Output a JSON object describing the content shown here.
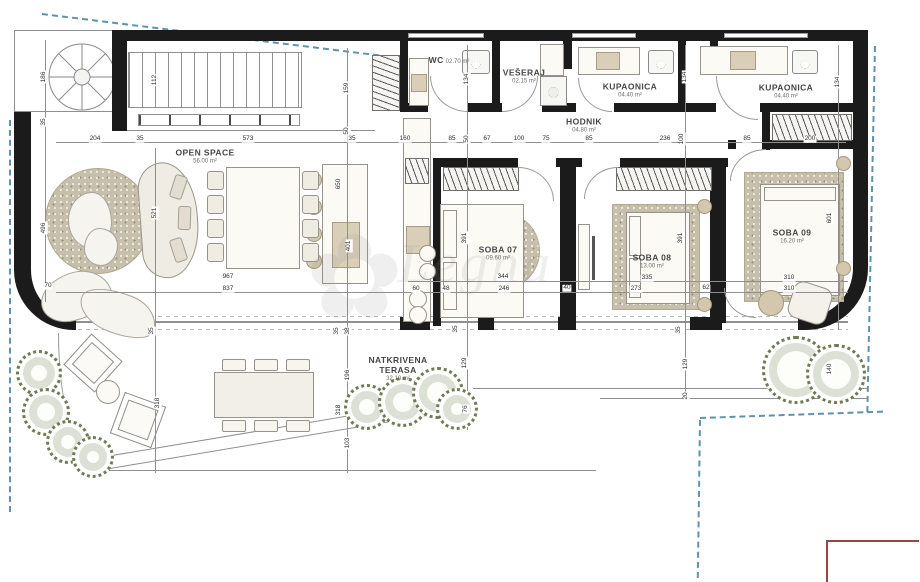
{
  "watermark": {
    "text": "Legna",
    "flower": "✿"
  },
  "colors": {
    "wall": "#1b1b1b",
    "thin_line": "#8f8f8f",
    "boundary": "#5d93ad",
    "red_outline": "#9a4543",
    "carpet": "#c6bfab",
    "fixture_beige": "#d9cfb8",
    "bush_green": "#6f7a57"
  },
  "rooms": [
    {
      "id": "open-space",
      "name": "OPEN SPACE",
      "area": "56.00 m²",
      "x": 205,
      "y": 157
    },
    {
      "id": "wc",
      "name": "WC",
      "area": "02.70 m²",
      "x": 449,
      "y": 61,
      "inline": true
    },
    {
      "id": "veseraj",
      "name": "VEŠERAJ",
      "area": "02.15 m²",
      "x": 524,
      "y": 77
    },
    {
      "id": "kupaonica-1",
      "name": "KUPAONICA",
      "area": "04.40 m²",
      "x": 630,
      "y": 91
    },
    {
      "id": "kupaonica-2",
      "name": "KUPAONICA",
      "area": "04.40 m²",
      "x": 786,
      "y": 92
    },
    {
      "id": "hodnik",
      "name": "HODNIK",
      "area": "04.80 m²",
      "x": 584,
      "y": 126
    },
    {
      "id": "soba-07",
      "name": "SOBA 07",
      "area": "09.60 m²",
      "x": 498,
      "y": 254
    },
    {
      "id": "soba-08",
      "name": "SOBA 08",
      "area": "13.00 m²",
      "x": 652,
      "y": 262
    },
    {
      "id": "soba-09",
      "name": "SOBA 09",
      "area": "16.20 m²",
      "x": 792,
      "y": 237
    },
    {
      "id": "terasa",
      "name": "NATKRIVENA TERASA",
      "area": "32.10 m²",
      "x": 398,
      "y": 369,
      "wide": true
    }
  ],
  "dims": [
    {
      "t": "204",
      "x": 95,
      "y": 139,
      "v": 0
    },
    {
      "t": "35",
      "x": 140,
      "y": 139,
      "v": 0
    },
    {
      "t": "573",
      "x": 248,
      "y": 139,
      "v": 0
    },
    {
      "t": "35",
      "x": 352,
      "y": 139,
      "v": 0
    },
    {
      "t": "160",
      "x": 405,
      "y": 139,
      "v": 0
    },
    {
      "t": "85",
      "x": 452,
      "y": 139,
      "v": 0
    },
    {
      "t": "50",
      "x": 467,
      "y": 139,
      "v": 1
    },
    {
      "t": "67",
      "x": 487,
      "y": 139,
      "v": 0
    },
    {
      "t": "100",
      "x": 519,
      "y": 139,
      "v": 0
    },
    {
      "t": "75",
      "x": 546,
      "y": 139,
      "v": 0
    },
    {
      "t": "85",
      "x": 589,
      "y": 139,
      "v": 0
    },
    {
      "t": "236",
      "x": 665,
      "y": 139,
      "v": 0
    },
    {
      "t": "100",
      "x": 682,
      "y": 139,
      "v": 1
    },
    {
      "t": "85",
      "x": 747,
      "y": 139,
      "v": 0
    },
    {
      "t": "200",
      "x": 810,
      "y": 139,
      "v": 0
    },
    {
      "t": "186",
      "x": 44,
      "y": 77,
      "v": 1
    },
    {
      "t": "35",
      "x": 44,
      "y": 122,
      "v": 1
    },
    {
      "t": "112",
      "x": 155,
      "y": 80,
      "v": 1
    },
    {
      "t": "159",
      "x": 347,
      "y": 88,
      "v": 1
    },
    {
      "t": "50",
      "x": 347,
      "y": 131,
      "v": 1
    },
    {
      "t": "134",
      "x": 467,
      "y": 79,
      "v": 1
    },
    {
      "t": "134",
      "x": 685,
      "y": 77,
      "v": 1
    },
    {
      "t": "134",
      "x": 838,
      "y": 82,
      "v": 1
    },
    {
      "t": "496",
      "x": 44,
      "y": 228,
      "v": 1
    },
    {
      "t": "70",
      "x": 48,
      "y": 286,
      "v": 0
    },
    {
      "t": "521",
      "x": 155,
      "y": 213,
      "v": 1
    },
    {
      "t": "650",
      "x": 339,
      "y": 184,
      "v": 1
    },
    {
      "t": "401",
      "x": 349,
      "y": 246,
      "v": 1
    },
    {
      "t": "391",
      "x": 465,
      "y": 238,
      "v": 1
    },
    {
      "t": "391",
      "x": 681,
      "y": 238,
      "v": 1
    },
    {
      "t": "601",
      "x": 830,
      "y": 218,
      "v": 1
    },
    {
      "t": "967",
      "x": 228,
      "y": 277,
      "v": 0
    },
    {
      "t": "837",
      "x": 228,
      "y": 289,
      "v": 0
    },
    {
      "t": "60",
      "x": 416,
      "y": 289,
      "v": 0
    },
    {
      "t": "48",
      "x": 446,
      "y": 289,
      "v": 0
    },
    {
      "t": "344",
      "x": 503,
      "y": 277,
      "v": 0
    },
    {
      "t": "246",
      "x": 504,
      "y": 289,
      "v": 0
    },
    {
      "t": "40",
      "x": 567,
      "y": 288,
      "v": 0
    },
    {
      "t": "335",
      "x": 647,
      "y": 278,
      "v": 0
    },
    {
      "t": "273",
      "x": 636,
      "y": 289,
      "v": 0
    },
    {
      "t": "62",
      "x": 706,
      "y": 288,
      "v": 0
    },
    {
      "t": "310",
      "x": 789,
      "y": 278,
      "v": 0
    },
    {
      "t": "310",
      "x": 789,
      "y": 289,
      "v": 0
    },
    {
      "t": "35",
      "x": 152,
      "y": 331,
      "v": 1
    },
    {
      "t": "35",
      "x": 337,
      "y": 331,
      "v": 1
    },
    {
      "t": "38",
      "x": 348,
      "y": 331,
      "v": 1
    },
    {
      "t": "35",
      "x": 456,
      "y": 329,
      "v": 1
    },
    {
      "t": "35",
      "x": 679,
      "y": 330,
      "v": 1
    },
    {
      "t": "318",
      "x": 158,
      "y": 403,
      "v": 1
    },
    {
      "t": "196",
      "x": 348,
      "y": 375,
      "v": 1
    },
    {
      "t": "103",
      "x": 348,
      "y": 443,
      "v": 1
    },
    {
      "t": "318",
      "x": 339,
      "y": 410,
      "v": 1
    },
    {
      "t": "129",
      "x": 465,
      "y": 363,
      "v": 1
    },
    {
      "t": "76",
      "x": 466,
      "y": 409,
      "v": 1
    },
    {
      "t": "129",
      "x": 686,
      "y": 364,
      "v": 1
    },
    {
      "t": "20",
      "x": 686,
      "y": 396,
      "v": 1
    },
    {
      "t": "140",
      "x": 830,
      "y": 369,
      "v": 1
    }
  ],
  "bushes": [
    {
      "x": 16,
      "y": 350,
      "d": 46
    },
    {
      "x": 22,
      "y": 388,
      "d": 48
    },
    {
      "x": 46,
      "y": 420,
      "d": 44
    },
    {
      "x": 72,
      "y": 436,
      "d": 42
    },
    {
      "x": 344,
      "y": 384,
      "d": 46
    },
    {
      "x": 378,
      "y": 377,
      "d": 50
    },
    {
      "x": 412,
      "y": 367,
      "d": 52
    },
    {
      "x": 436,
      "y": 388,
      "d": 42
    },
    {
      "x": 762,
      "y": 336,
      "d": 68
    },
    {
      "x": 806,
      "y": 344,
      "d": 60
    }
  ],
  "circles": [
    {
      "x": 419,
      "y": 245,
      "d": 17,
      "c": "w"
    },
    {
      "x": 419,
      "y": 263,
      "d": 17,
      "c": "w"
    },
    {
      "x": 697,
      "y": 199,
      "d": 15,
      "c": "b"
    },
    {
      "x": 697,
      "y": 297,
      "d": 15,
      "c": "b"
    },
    {
      "x": 836,
      "y": 156,
      "d": 15,
      "c": "b"
    },
    {
      "x": 836,
      "y": 261,
      "d": 15,
      "c": "b"
    },
    {
      "x": 306,
      "y": 172,
      "d": 16,
      "c": "b"
    },
    {
      "x": 306,
      "y": 199,
      "d": 16,
      "c": "b"
    },
    {
      "x": 306,
      "y": 226,
      "d": 16,
      "c": "b"
    },
    {
      "x": 306,
      "y": 253,
      "d": 16,
      "c": "b"
    },
    {
      "x": 96,
      "y": 380,
      "d": 24,
      "c": "w"
    },
    {
      "x": 758,
      "y": 290,
      "d": 26,
      "c": "b"
    },
    {
      "x": 409,
      "y": 290,
      "d": 18,
      "c": "w"
    },
    {
      "x": 409,
      "y": 306,
      "d": 18,
      "c": "w"
    }
  ],
  "dining_chairs": [
    {
      "x": 207,
      "y": 171
    },
    {
      "x": 207,
      "y": 195
    },
    {
      "x": 207,
      "y": 219
    },
    {
      "x": 207,
      "y": 243
    },
    {
      "x": 302,
      "y": 171
    },
    {
      "x": 302,
      "y": 195
    },
    {
      "x": 302,
      "y": 219
    },
    {
      "x": 302,
      "y": 243
    }
  ],
  "outdoor_chairs": [
    {
      "x": 222,
      "y": 359
    },
    {
      "x": 254,
      "y": 359
    },
    {
      "x": 286,
      "y": 359
    },
    {
      "x": 222,
      "y": 420
    },
    {
      "x": 254,
      "y": 420
    },
    {
      "x": 286,
      "y": 420
    }
  ]
}
